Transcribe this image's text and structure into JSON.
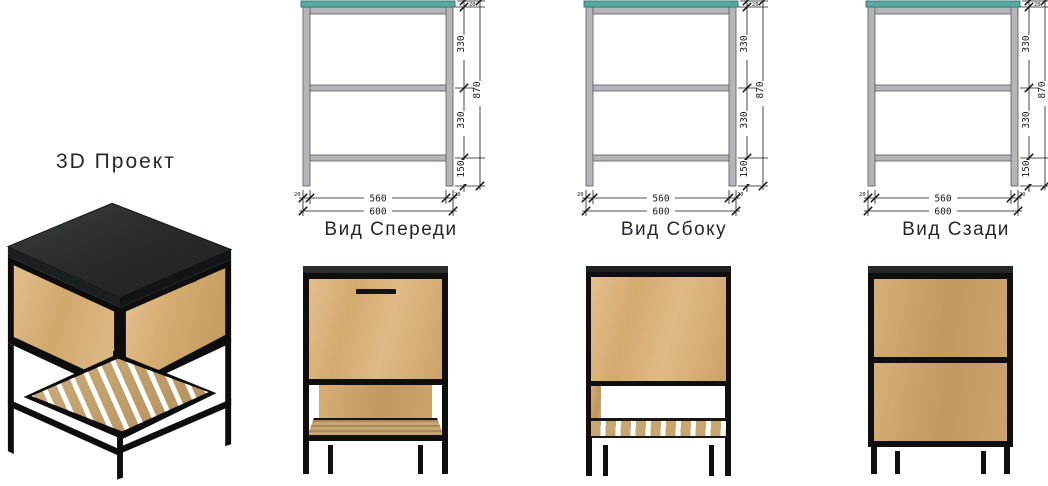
{
  "page": {
    "title_3d": "3D Проект"
  },
  "views": {
    "front": {
      "label": "Вид Спереди"
    },
    "side": {
      "label": "Вид Сбоку"
    },
    "back": {
      "label": "Вид Сзади"
    }
  },
  "dimensions": {
    "total_height": "870",
    "upper_section": "330",
    "middle_section": "330",
    "lower_section": "150",
    "inner_width": "560",
    "outer_width": "600",
    "frame_profile": "20"
  },
  "colors": {
    "countertop_accent": "#58a9a2",
    "drawing_frame_gray": "#b5b5b8",
    "wood_oak": "#d9b27c",
    "metal_black": "#0f0f0f",
    "stone_top": "#2b2e2f"
  }
}
